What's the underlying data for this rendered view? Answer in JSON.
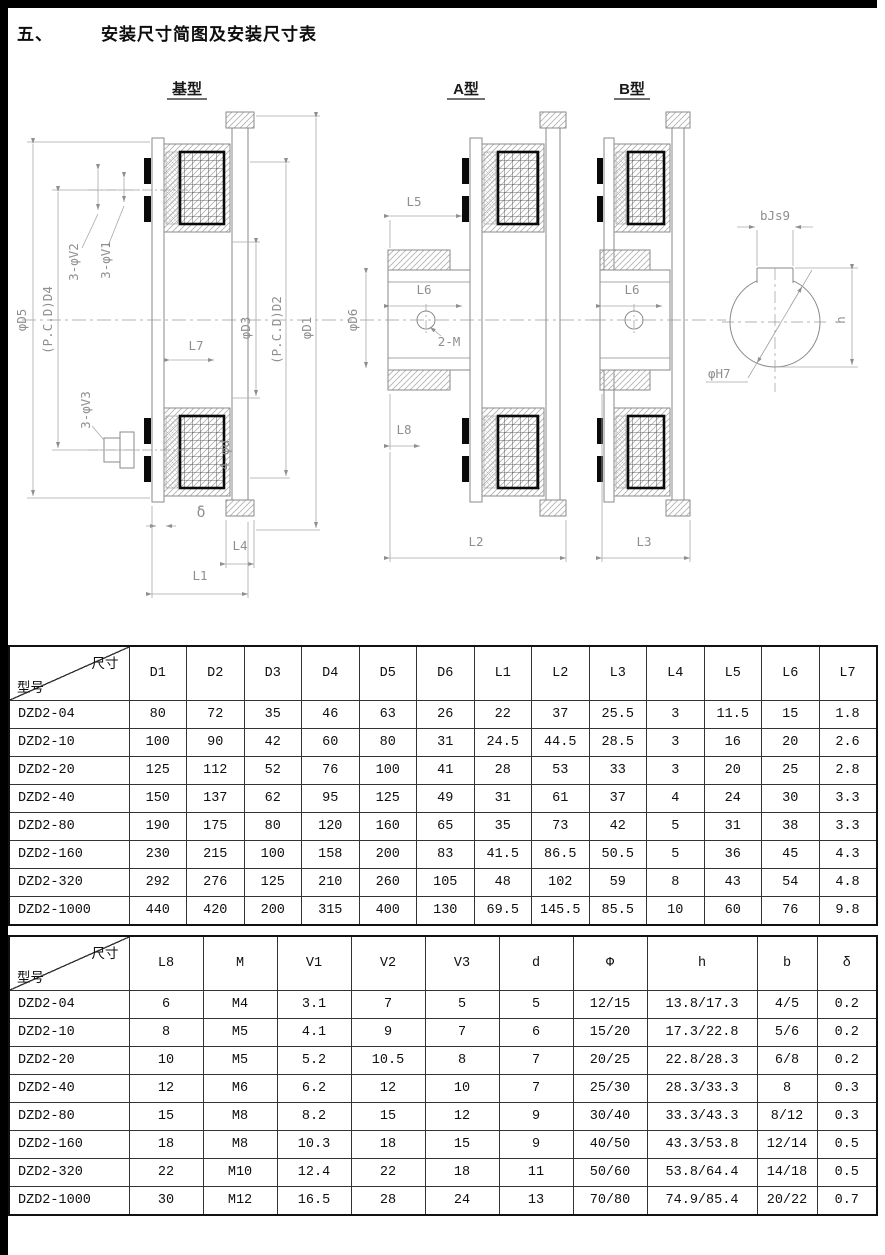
{
  "page": {
    "section_number": "五、",
    "title": "安装尺寸简图及安装尺寸表"
  },
  "diagrams": {
    "jixing": {
      "title": "基型",
      "labels": {
        "phiD5": "φD5",
        "pcdD4": "(P.C.D)D4",
        "v2": "3-φV2",
        "v1": "3-φV1",
        "phiD3": "φD3",
        "pcdD2": "(P.C.D)D2",
        "phiD1": "φD1",
        "l7": "L7",
        "v3": "3-φV3",
        "phid": "4-φd",
        "delta": "δ",
        "l4": "L4",
        "l1": "L1"
      }
    },
    "axing": {
      "title": "A型",
      "labels": {
        "l5": "L5",
        "l6": "L6",
        "phiD6": "φD6",
        "m2": "2-M",
        "l8": "L8",
        "l2": "L2"
      }
    },
    "bxing": {
      "title": "B型",
      "labels": {
        "l6": "L6",
        "l3": "L3"
      }
    },
    "shaft": {
      "labels": {
        "bjs9": "bJs9",
        "h": "h",
        "phiH7": "φH7"
      }
    }
  },
  "table1": {
    "corner_top": "尺寸",
    "corner_bottom": "型号",
    "columns": [
      "D1",
      "D2",
      "D3",
      "D4",
      "D5",
      "D6",
      "L1",
      "L2",
      "L3",
      "L4",
      "L5",
      "L6",
      "L7"
    ],
    "rows": [
      {
        "model": "DZD2-04",
        "values": [
          "80",
          "72",
          "35",
          "46",
          "63",
          "26",
          "22",
          "37",
          "25.5",
          "3",
          "11.5",
          "15",
          "1.8"
        ]
      },
      {
        "model": "DZD2-10",
        "values": [
          "100",
          "90",
          "42",
          "60",
          "80",
          "31",
          "24.5",
          "44.5",
          "28.5",
          "3",
          "16",
          "20",
          "2.6"
        ]
      },
      {
        "model": "DZD2-20",
        "values": [
          "125",
          "112",
          "52",
          "76",
          "100",
          "41",
          "28",
          "53",
          "33",
          "3",
          "20",
          "25",
          "2.8"
        ]
      },
      {
        "model": "DZD2-40",
        "values": [
          "150",
          "137",
          "62",
          "95",
          "125",
          "49",
          "31",
          "61",
          "37",
          "4",
          "24",
          "30",
          "3.3"
        ]
      },
      {
        "model": "DZD2-80",
        "values": [
          "190",
          "175",
          "80",
          "120",
          "160",
          "65",
          "35",
          "73",
          "42",
          "5",
          "31",
          "38",
          "3.3"
        ]
      },
      {
        "model": "DZD2-160",
        "values": [
          "230",
          "215",
          "100",
          "158",
          "200",
          "83",
          "41.5",
          "86.5",
          "50.5",
          "5",
          "36",
          "45",
          "4.3"
        ]
      },
      {
        "model": "DZD2-320",
        "values": [
          "292",
          "276",
          "125",
          "210",
          "260",
          "105",
          "48",
          "102",
          "59",
          "8",
          "43",
          "54",
          "4.8"
        ]
      },
      {
        "model": "DZD2-1000",
        "values": [
          "440",
          "420",
          "200",
          "315",
          "400",
          "130",
          "69.5",
          "145.5",
          "85.5",
          "10",
          "60",
          "76",
          "9.8"
        ]
      }
    ]
  },
  "table2": {
    "corner_top": "尺寸",
    "corner_bottom": "型号",
    "columns": [
      "L8",
      "M",
      "V1",
      "V2",
      "V3",
      "d",
      "Φ",
      "h",
      "b",
      "δ"
    ],
    "rows": [
      {
        "model": "DZD2-04",
        "values": [
          "6",
          "M4",
          "3.1",
          "7",
          "5",
          "5",
          "12/15",
          "13.8/17.3",
          "4/5",
          "0.2"
        ]
      },
      {
        "model": "DZD2-10",
        "values": [
          "8",
          "M5",
          "4.1",
          "9",
          "7",
          "6",
          "15/20",
          "17.3/22.8",
          "5/6",
          "0.2"
        ]
      },
      {
        "model": "DZD2-20",
        "values": [
          "10",
          "M5",
          "5.2",
          "10.5",
          "8",
          "7",
          "20/25",
          "22.8/28.3",
          "6/8",
          "0.2"
        ]
      },
      {
        "model": "DZD2-40",
        "values": [
          "12",
          "M6",
          "6.2",
          "12",
          "10",
          "7",
          "25/30",
          "28.3/33.3",
          "8",
          "0.3"
        ]
      },
      {
        "model": "DZD2-80",
        "values": [
          "15",
          "M8",
          "8.2",
          "15",
          "12",
          "9",
          "30/40",
          "33.3/43.3",
          "8/12",
          "0.3"
        ]
      },
      {
        "model": "DZD2-160",
        "values": [
          "18",
          "M8",
          "10.3",
          "18",
          "15",
          "9",
          "40/50",
          "43.3/53.8",
          "12/14",
          "0.5"
        ]
      },
      {
        "model": "DZD2-320",
        "values": [
          "22",
          "M10",
          "12.4",
          "22",
          "18",
          "11",
          "50/60",
          "53.8/64.4",
          "14/18",
          "0.5"
        ]
      },
      {
        "model": "DZD2-1000",
        "values": [
          "30",
          "M12",
          "16.5",
          "28",
          "24",
          "13",
          "70/80",
          "74.9/85.4",
          "20/22",
          "0.7"
        ]
      }
    ]
  }
}
